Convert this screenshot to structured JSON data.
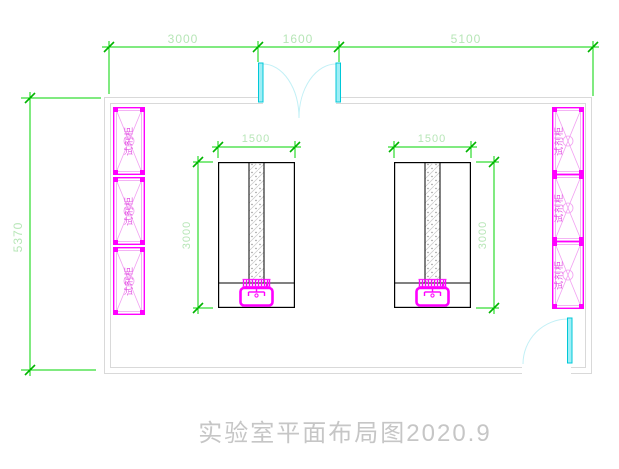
{
  "drawing_title": "实验室平面布局图2020.9",
  "dimensions": {
    "top_segments": [
      "3000",
      "1600",
      "5100"
    ],
    "room_height": "5370",
    "bench_width": "1500",
    "bench_length": "3000"
  },
  "cabinet_label": "试剂柜",
  "colors": {
    "dimension_line": "#00d400",
    "dimension_text": "#b7e6b7",
    "cabinet_magenta": "#ff00ff",
    "cabinet_light": "#f2a0f2",
    "door_cyan": "#9feef6",
    "door_arc": "#c2f0f6",
    "wall_gray": "#d9d9d9",
    "bench_black": "#000000",
    "title_gray": "#c6c6c6",
    "background": "#ffffff"
  }
}
